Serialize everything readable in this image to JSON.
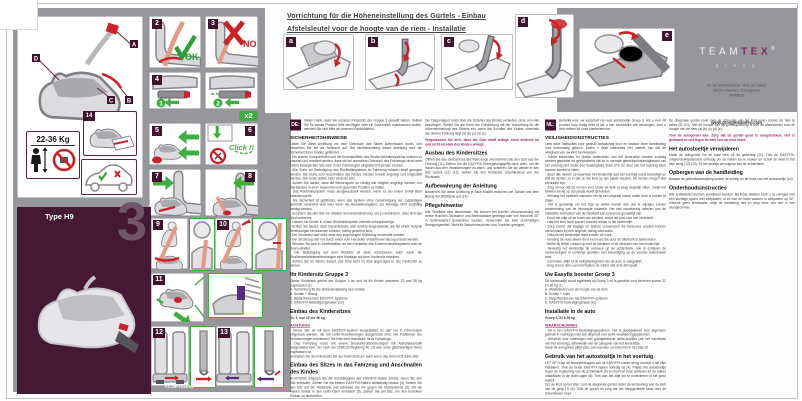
{
  "header": {
    "line_de": "Vorrichtung für die Höheneinstellung des Gürtels - Einbau",
    "line_nl": "Afstelsleutel voor de hoogte van de riem - Installatie"
  },
  "brand": {
    "team": "TEAM",
    "tex": "TEX",
    "reg": "®",
    "group": "g r o u p",
    "address": "ZI. de Montbertrand - Rue du Claret\n38230 Charvieu Chavagneux\nFRANCE",
    "website": "www.groupeteamtex.com"
  },
  "panel": {
    "type_label": "Type H9",
    "group_number": "3",
    "doc_code": "FC26FRDENL",
    "weight_label": "22-36 Kg"
  },
  "fig": {
    "f1": "1",
    "f2": "2",
    "f3": "3",
    "f4a": "4",
    "f5": "5",
    "f6": "6",
    "f7": "7",
    "f8": "8",
    "f9": "9",
    "f10": "10",
    "f11": "11",
    "f12": "12",
    "f13": "13",
    "f14": "14",
    "la": "a",
    "lb": "b",
    "lc": "c",
    "ld": "d",
    "le": "e",
    "callA": "A",
    "callB": "B",
    "callC": "C",
    "callD": "D",
    "ok": "OK",
    "no": "NO",
    "x2": "x2",
    "click": "Click !!",
    "step1": "1",
    "step2": "2"
  },
  "col_de1": {
    "badge": "DE:",
    "intro": "Vielen Dank, dass Sie unseren Kindersitz der Gruppe 3 gekauft haben. Sollten Sie für dieses Produkt Hilfe benötigen oder ein Zubehörteil austauschen wollen, wenden Sie sich bitte an unseren Kundendienst.",
    "safety_h": "SICHERHEITSHINWEISE",
    "safety_b": "Lesen Sie diese Anleitung vor dem Gebrauch des Sitzes aufmerksam durch, und bewahren Sie sie als Referenz auf. Bei Nichtbeachtung dieser Anleitung wird die Sicherheit Ihres Kindes gefährdet.\n- Die starren Komponenten und die Kunststoffteile des Kinderrückhaltesystems müssen so platziert und montiert werden, dass sie bei normalem Gebrauch des Fahrzeugs nicht unter einem beweglichen Sitz oder in der Fahrzeugtür eingeklemmt werden können.\n- Alle Gurte zur Befestigung des Rückhaltesystems im Fahrzeug müssen straff gezogen werden. Die Gurte zum Anschnallen des Kindes müssen korrekt angelegt und eingestellt werden. Die Gurte dürfen nicht verdreht sein.\n- Achten Sie darauf, dass die Beckengurte so niedrig wie möglich angelegt werden, um das Becken in einer bequemen und gesunden Position zu halten.\n- Das Rückhaltesystem muss ausgewechselt werden, wenn es bei einem Unfall stark belastet wurde.\n- Die Sicherheit ist gefährdet, wenn das System ohne Genehmigung der zuständigen Behörde verändert wird oder wenn die Herstellerangaben zur Montage nicht sorgfältig befolgt werden.\n- Schützen Sie den Sitz vor direkter Sonneneinstrahlung, um zu verhindern, dass sich das Kind verbrennt.\n- Lassen Sie Kinder in einem Rückhaltesystem niemals unbeaufsichtigt.\n- Achten Sie darauf, dass Gepäckstücke oder andere Gegenstände, die bei einem Aufprall Verletzungen verursachen können, richtig gesichert sind.\n- Der Kindersitz darf nicht ohne den zugehörigen Sitzbezug verwendet werden.\n- Der Sitzbezug darf nur durch einen vom Hersteller empfohlenen Bezug ersetzt werden.\n- Wenden Sie sich in Zweifelsfällen an den Hersteller des Kinderrückhaltesystems oder an Ihren Händler.\n- Die Befestigung auf dem Rücksitz ist stets vorzuziehen, auch wenn die Straßenverkehrsbestimmungen eine Montage auf dem Vordersitz erlauben.\n- Achten Sie im Winter darauf, das Kind nicht zu dick angezogen in den Kindersitz zu setzen.",
    "seat_h": "Ihr Kindersitz Gruppe 3",
    "seat_b": "Dieser Kindersitz gehört der Gruppe 3 an und ist für Kinder zwischen 22 und 36 kg zugelassen (1).\nA. Vorrichtung für die Höheneinstellung des Gürtels\nB. Schale + Bezug\nC. Bedienhebel des EASYFIX-Systems\nD. EASYFIX-Befestigungshaken (x2)",
    "install_h": "Einbau des Kindersitzes",
    "install_sub": "Gr. 3, von 22 bis 36 kg",
    "warn_h": "ACHTUNG!",
    "warn_b": "- Dieser Sitz ist mit dem EASYFIX-System ausgestattet. Er darf nur in Fahrzeugen eingebaut werden, die mit Isofix-Verankerungen ausgerüstet sind. Die Positionen der Verankerungen entnehmen Sie bitte dem Handbuch Ihres Fahrzeugs.\n- Das Fahrzeug muss mit einem Dreipunkt-Sicherheitsgurt mit Aufrollautomatik ausgestattet sein, der nach der UN/ECE-Regelung Nr. 16 oder einer gleichwertigen Norm zugelassen ist.\nSchnallen Sie den Kindersitz bei der Fahrt stets an, auch wenn das Kind nicht darin sitzt.",
    "belt_h": "Einbau des Sitzes in das Fahrzeug und Anschnallen des Kindes",
    "belt_b": "ACHTUNG: Klappen Sie die Schutzkappen der EASYFIX-Haken zurück, bevor Sie den Sitz einbauen. Ziehen Sie die beiden EASYFIX-Haken vollständig heraus (4). Setzen Sie den Sitz auf die Rückbank und schieben Sie ihn gegen die Rückenlehne (5), bis die Haken hörbar in den Isofix-Ösen einrasten (6). Ziehen Sie am Sitz, um den korrekten Einbau zu überprüfen.\nSetzen Sie Ihr Kind auf den Sitz. Führen Sie den Diagonalgurt unter der Armlehne auf der Seite des Gurtschlosses durch (7) (8). Schließen Sie den Gurt und achten Sie darauf, dass der Beckengurt straff über den Oberschenkeln liegt (9) (10)."
  },
  "col_de2": {
    "cont": "Der Diagonalgurt muss über die Schulter des Kindes verlaufen, ohne am Hals anzuliegen. Stellen Sie die Höhe der Gurtführung mit der Vorrichtung für die Höheneinstellung des Gürtels ein, wenn die Schulter des Kindes unterhalb der oberen Führung liegt (a) (b) (c) (d) (e).",
    "accent": "Vergewissern Sie sich, dass der Gurt straff anliegt, nicht verdreht ist und nicht am Hals des Kindes anliegt.",
    "removal_h": "Ausbau des Kindersitzes",
    "removal_b": "Öffnen Sie das Gurtschloss des Fahrzeugs und nehmen Sie den Gurt aus der Führung (11). Ziehen Sie die EASYFIX-Entriegelungsgriffe nach oben, um die Haken aus den Verankerungen zu lösen, und schieben Sie sie wieder in den Sitz zurück (12) (13). Heben Sie den Kindersitz anschließend von der Rückbank.",
    "manual_h": "Aufbewahrung der Anleitung",
    "manual_b": "Bewahren Sie diese Anleitung je nach Modell zwischen der Schale und dem Bezug der Sitzfläche auf (14).",
    "care_h": "Pflegehinweise",
    "care_b": "Alle Textilteile sind abnehmbar. Sie können bei leichter Verschmutzung mit einem feuchten Schwamm und Seifenwasser gereinigt oder von Hand bei 30° in Seifenwasser gewaschen werden. Verwenden Sie kein chlorhaltiges Reinigungsmittel. Nicht für Waschmaschinen und Trockner geeignet."
  },
  "col_nl1": {
    "badge": "NL:",
    "intro": "Bedankt voor uw aanschaf van een autostoeltje Groep 3. Als u voor dit product hulp nodig hebt of als u een accessoire wilt vervangen, kunt u zich richten tot onze klantenservice.",
    "safety_h": "VEILIGHEIDSINSTRUCTIES",
    "safety_b": "Lees deze instructies voor gebruik aandachtig door en bewaar deze handleiding voor toekomstig gebruik. Indien u deze instructies niet naleeft, kan dat de veiligheid van uw kind beïnvloeden.\n- Harde elementen en plastic onderdelen van het kinderzitje moeten zodanig worden geplaatst en geïnstalleerd dat ze in normale gebruiksomstandigheden van het voertuig niet onder een beweegbare stoel of in de deur van het voertuig klem kunnen komen te zitten.\n- Span alle riemen op waarmee het kinderzitje aan het voertuig wordt bevestigd en stel de riemen zo in dat ze het kind op zijn plaats houden. De riemen mogen niet verdraaid zijn.\n- Zorg ervoor dat de riemen voor onder de buik zo laag mogelijk zitten, zodat het bekken stevig op zijn plaats wordt gehouden.\n- Vervang het systeem wanneer het bij een ongeval zwaar onder druk is komen te staan.\n- Het is gevaarlijk om het zitje op welke manier dan ook te wijzigen zonder toestemming van de bevoegde instantie. Het niet nauwkeurig naleven van de installatie-instructies van de fabrikant kan eveneens gevaarlijk zijn.\n- Houd het zitje uit de buurt van zonlicht, zodat het kind zich niet verbrandt.\n- Laat het kind nooit zonder toezicht achter in het kinderzitje.\n- Zorg ervoor dat bagage en andere voorwerpen die blessures zouden kunnen veroorzaken bij een ongeluk, stevig vast staan.\n- Gebruik het kinderzitje nooit zonder de hoes.\n- Vervang de hoes alleen door een hoes die door de fabrikant is aanbevolen.\n- Neem bij twijfel contact op met de fabrikant of de verkoper van het kinderzitje.\n- Bevestig het kinderzitje bij voorkeur op de achterbank, ook al schrijven de verkeersregels in sommige gevallen een bevestiging op de voorste autostoelen voor.\n- Controleer altijd of de veiligheidsgordel van de auto is vastgeklikt.\n- Zorg ervoor dat u uw kind tijdens de winter niet al te dik inpakt.",
    "seat_h": "Uw Easyfix booster Groep 3",
    "seat_b": "Dit autostoeltje wordt ingedeeld bij Groep 3 en is geschikt voor kinderen tussen 22 en 36 kg (1).\nA. Afstelsleutel voor de hoogte van de riem\nB. Schelp + hoes\nC. Regelhendel van het EASYFIX-systeem\nD. EASYFIX-bevestigingshaak (x2)",
    "install_h": "Installatie in de auto",
    "install_sub": "Groep 3, 22 à 36 kg",
    "warn_h": "WAARSCHUWING",
    "warn_b": "- Dit is een EASYFIX-bevestigingssysteem. Het is goedgekeurd voor algemeen gebruik in voertuigen die zijn uitgerust met Isofix-verankeringssystemen.\n- Geschikt voor voertuigen met goedgekeurde Isofix-posities (zie het handboek van het voertuig), afhankelijk van de categorie van het kinderzitje.\nGesp de autogordel altijd vast, ook wanneer uw kind niet in het zitje zit.",
    "use_h": "Gebruik van het autostoeltje in het voertuig",
    "use_b": "LET OP: Klap de beschermkapjes van de EASYFIX-haken terug voordat u het zitje installeert. Trek de beide EASYFIX-haken volledig uit (4). Plaats het autostoeltje tegen de rugleuning van de achterbank (5) en duw het naar achteren tot de haken vastklikken in de Isofix-ogen (6). Trek aan het zitje om te controleren of het goed vastzit.\nZet uw kind op het zitje. Leid de diagonale gordel onder de armleuning aan de kant van de gesp (7) (8). Sluit de gordel en zorg dat het heupgedeelte strak over de bovenbenen loopt."
  },
  "col_nl2": {
    "cont": "De diagonale gordel moet over de schouder van het kind lopen zonder de hals te raken (9) (10). Stel de hoogte van de gordelgeleiding af met de afstelsleutel voor de hoogte van de riem (a) (b) (c) (d) (e).",
    "accent": "Trek de autogordel aan. Zorg dat de gordel goed is aangetrokken, niet is gedraaid en niet tegen de hals van uw kind komt.",
    "removal_h": "Het autostoeltje verwijderen",
    "removal_b": "Maak de autogordel los en haal hem uit de geleiding (11). Trek de EASYFIX-ontgrendelingshendels omhoog om de haken los te maken en schuif ze weer in het zitje terug (12) (13). Til het stoeltje vervolgens van de achterbank.",
    "manual_h": "Opbergen van de handleiding",
    "manual_b": "Bewaar de gebruiksaanwijzing tussen de schelp en de hoes van het autostoeltje (14).",
    "care_h": "Onderhoudsinstructies",
    "care_b": "Alle textieldelen kunnen verwijderd worden. Bij lichte vlekken kunt u ze reinigen met een vochtige spons met zeepwater, of ze met de hand wassen in zeepwater op 30°. Gebruik geen bleekwater, strijk de bekleding niet en stop deze ook niet in een droogtrommel."
  }
}
